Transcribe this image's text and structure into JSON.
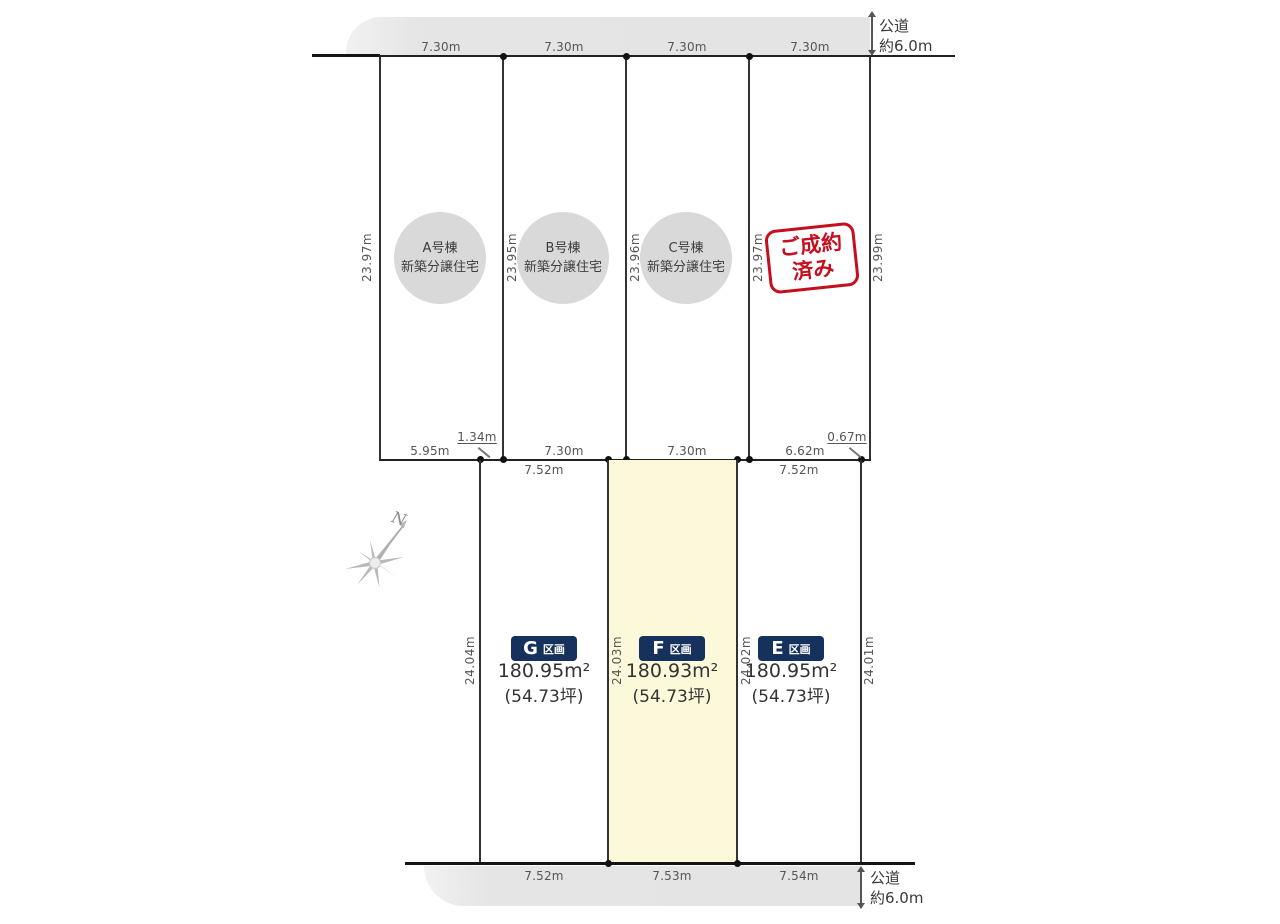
{
  "compass": {
    "north_label": "N"
  },
  "road_top": {
    "name_line1": "公道",
    "name_line2": "約6.0m",
    "segment_labels": [
      "7.30m",
      "7.30m",
      "7.30m",
      "7.30m"
    ]
  },
  "road_bottom": {
    "name_line1": "公道",
    "name_line2": "約6.0m",
    "segment_labels": [
      "7.52m",
      "7.53m",
      "7.54m"
    ]
  },
  "upper_section": {
    "side_labels": [
      "23.97m",
      "23.95m",
      "23.96m",
      "23.97m",
      "23.99m"
    ],
    "plots": [
      {
        "building": "A号棟",
        "type": "新築分譲住宅"
      },
      {
        "building": "B号棟",
        "type": "新築分譲住宅"
      },
      {
        "building": "C号棟",
        "type": "新築分譲住宅"
      }
    ],
    "sold_stamp": {
      "line1": "ご成約",
      "line2": "済み"
    },
    "bottom_labels": {
      "a_left": "5.95m",
      "a_right": "1.34m",
      "b": "7.30m",
      "c": "7.30m",
      "d_main": "6.62m",
      "d_right": "0.67m"
    }
  },
  "lower_section": {
    "side_labels": [
      "24.04m",
      "24.03m",
      "24.02m",
      "24.01m"
    ],
    "top_labels": [
      "7.52m",
      "7.52m",
      "7.52m"
    ],
    "plots": [
      {
        "letter": "G",
        "suffix": "区画",
        "area": "180.95m²",
        "tsubo": "(54.73坪)"
      },
      {
        "letter": "F",
        "suffix": "区画",
        "area": "180.93m²",
        "tsubo": "(54.73坪)"
      },
      {
        "letter": "E",
        "suffix": "区画",
        "area": "180.95m²",
        "tsubo": "(54.73坪)"
      }
    ]
  },
  "colors": {
    "accent_navy": "#16325c",
    "sold_red": "#c60f1e",
    "highlight_yellow": "#fcf8da",
    "road_gray": "#e4e4e4",
    "circle_gray": "#d9d9d9"
  }
}
